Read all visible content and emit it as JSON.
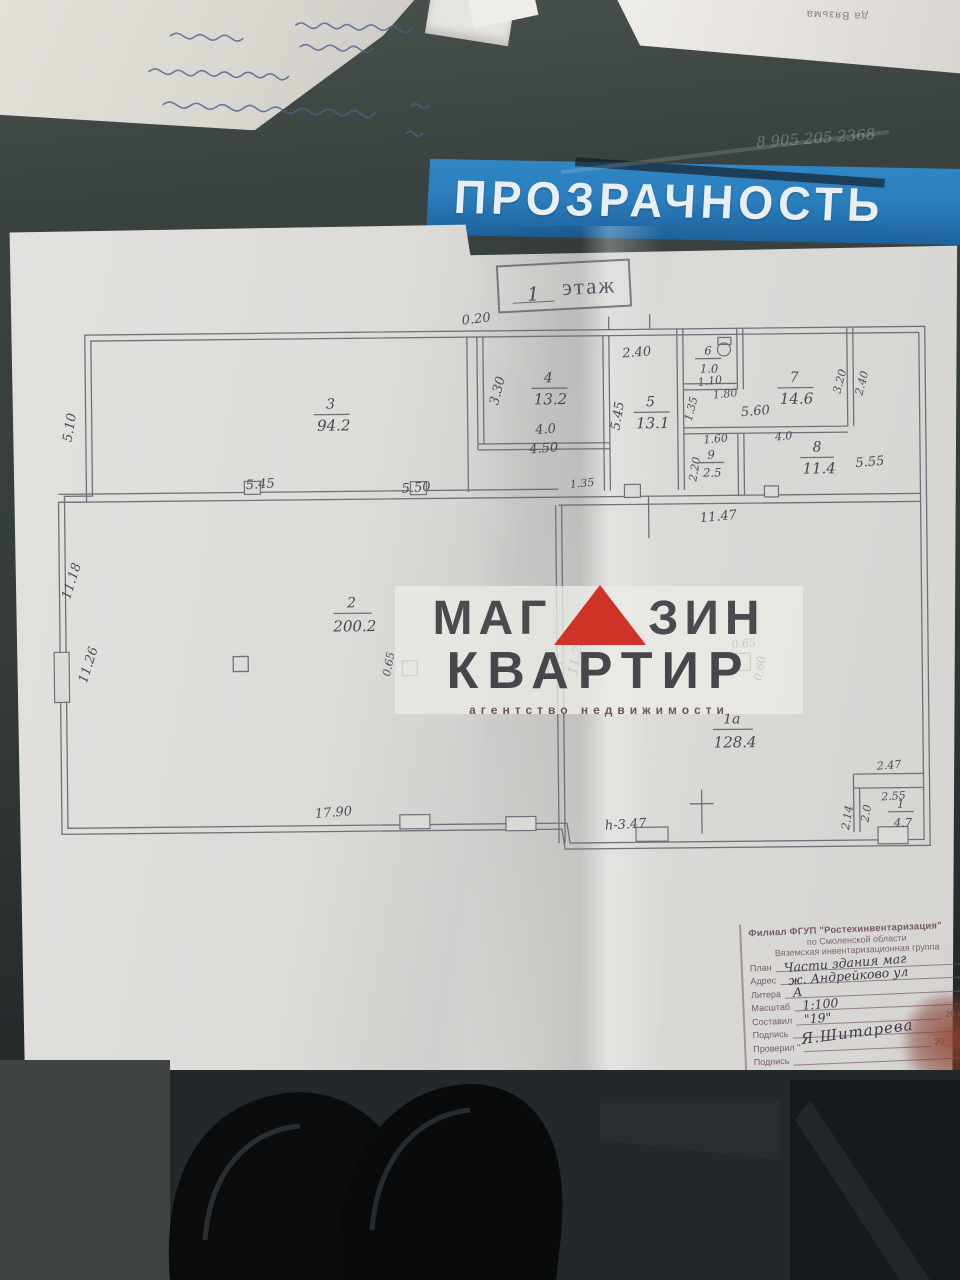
{
  "colors": {
    "banner_blue": "#2b7fbf",
    "logo_red": "#cf3227",
    "ink": "#4b4b55",
    "stamp_ink": "#74596b"
  },
  "background": {
    "banner_text": "ПРОЗРАЧНОСТЬ",
    "edge_text": "да Вязьма",
    "glass_scribble": "8 905 205 2368"
  },
  "plan": {
    "title": {
      "number": "1",
      "word": "этаж"
    },
    "rooms": [
      {
        "num": "3",
        "area": "94.2"
      },
      {
        "num": "4",
        "area": "13.2"
      },
      {
        "num": "5",
        "area": "13.1"
      },
      {
        "num": "6",
        "area": "1.0"
      },
      {
        "num": "7",
        "area": "14.6"
      },
      {
        "num": "8",
        "area": "11.4"
      },
      {
        "num": "9",
        "area": "2.5"
      },
      {
        "num": "2",
        "area": "200.2"
      },
      {
        "num": "1а",
        "area": "128.4"
      },
      {
        "num": "1",
        "area": "4.7"
      }
    ],
    "dims": [
      "5.10",
      "0.20",
      "5.45",
      "5.50",
      "3.30",
      "4.0",
      "4.50",
      "2.40",
      "5.45",
      "1.10",
      "1.35",
      "1.80",
      "3.20",
      "2.40",
      "5.60",
      "4.0",
      "1.60",
      "2.20",
      "5.55",
      "1.35",
      "11.47",
      "11.18",
      "11.26",
      "0.65",
      "11.25",
      "0.65",
      "0.60",
      "17.90",
      "h-3.47",
      "2.47",
      "2.55",
      "2.0",
      "2.14"
    ]
  },
  "watermark": {
    "part1": "МАГ",
    "part2": "ЗИН",
    "line2": "КВАРТИР",
    "line3": "агентство недвижимости"
  },
  "stamp": {
    "org1": "Филиал ФГУП \"Ростехинвентаризация\"",
    "org2": "по Смоленской области",
    "org3": "Вяземская инвентаризационная группа",
    "rows": [
      {
        "label": "План",
        "value": "Части здания маг"
      },
      {
        "label": "Адрес",
        "value": "ж. Андрейково ул"
      },
      {
        "label": "Литера",
        "value": "А"
      },
      {
        "label": "Масштаб",
        "value": "1:100"
      },
      {
        "label": "Составил",
        "value": "\"19\"",
        "suffix": "20 04"
      },
      {
        "label": "Подпись",
        "value": "Я.Шитарева"
      },
      {
        "label": "Проверил \"",
        "value": "",
        "suffix": "20 ___ г."
      },
      {
        "label": "Подпись",
        "value": ""
      }
    ]
  }
}
